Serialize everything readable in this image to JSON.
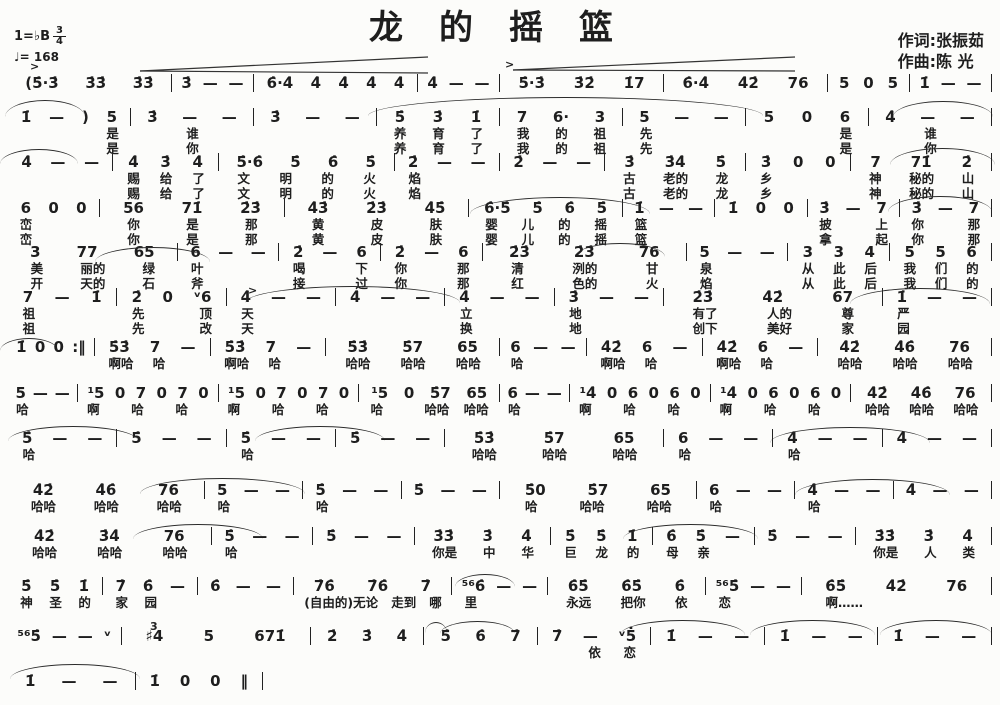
{
  "colors": {
    "ink": "#1e1e1e",
    "paper": "#fcfcfa"
  },
  "header": {
    "title": "龙的摇篮",
    "key": "1=♭B",
    "time_numerator": "3",
    "time_denominator": "4",
    "tempo": "♩= 168",
    "lyricist": "作词:张振茹",
    "composer": "作曲:陈  光"
  },
  "systems": [
    {
      "top": 74,
      "notes": [
        "(5̇·3̇ 3̇3̇ 3̇3̇",
        "3̇ — —",
        "6̇·4̇ 4̇ 4̇ 4̇ 4̇",
        "4̇ — —",
        "5̇·3̇ 3̇2̇ 1̇7",
        "6̇·4̇ 4̇2̇ 76",
        "5 0 5",
        "1̇ — —"
      ],
      "lyrics": []
    },
    {
      "top": 108,
      "notes": [
        "1̇ — ) 5",
        "3̇ — —",
        "3̇ — —",
        "5̇ 3̇ 1̇",
        "7 6· 3",
        "5 — —",
        "5 0 6",
        "4̇ — —"
      ],
      "lyrics": [
        [
          "　 　 　 是",
          "谁",
          "",
          "养 育 了",
          "我 的 祖",
          "先 　 　",
          "　 　 是",
          "谁"
        ],
        [
          "　 　 　 是",
          "你",
          "",
          "养 育 了",
          "我 的 祖",
          "先 　 　",
          "　 　 是",
          "你"
        ]
      ]
    },
    {
      "top": 153,
      "notes": [
        "4̇ — —",
        "4̇ 3̇ 4̇",
        "5̇·6̇ 5̇ 6̇ 5̇",
        "2̇ — —",
        "2̇ — —",
        "3̇ 3̇4̇ 5̇",
        "3̇ 0 0",
        "7 71̇ 2̇"
      ],
      "lyrics": [
        [
          "",
          "赐 给 了",
          "文 明 的 火",
          "焰 　 　",
          "",
          "古 老的 龙",
          "乡 　 　",
          "神 秘的 山"
        ],
        [
          "",
          "赐 给 了",
          "文 明 的 火",
          "焰 　 　",
          "",
          "古 老的 龙",
          "乡 　 　",
          "神 秘的 山"
        ]
      ]
    },
    {
      "top": 199,
      "notes": [
        "6 0 0",
        "56 71̇ 2̇3̇",
        "4̇3̇ 2̇3̇ 4̇5̇",
        "6̇·5̇ 5̇ 6̇ 5̇",
        "1̇ — —",
        "1̇ 0 0",
        "3̇ — 7",
        "3̇ — 7"
      ],
      "lyrics": [
        [
          "峦 　 　",
          "你 是 那",
          "黄 皮 肤",
          "婴 儿 的 摇",
          "篮 　 　",
          "",
          "披 　 上",
          "你 　 那"
        ],
        [
          "峦 　 　",
          "你 是 那",
          "黄 皮 肤",
          "婴 儿 的 摇",
          "篮 　 　",
          "",
          "拿 　 起",
          "你 　 那"
        ]
      ]
    },
    {
      "top": 243,
      "notes": [
        "3 77 65",
        "6 — —",
        "2̇ — 6",
        "2̇ — 6",
        "2̇3̇ 2̇3̇ 76",
        "5 — —",
        "3 3 4",
        "5 5 6"
      ],
      "lyrics": [
        [
          "美 丽的 绿",
          "叶 　 　",
          "喝 　 下",
          "你 　 那",
          "清 洌的 甘",
          "泉 　 　",
          "从 此 后",
          "我 们 的"
        ],
        [
          "开 天的 石",
          "斧 　 　",
          "接 　 过",
          "你 　 那",
          "红 色的 火",
          "焰 　 　",
          "从 此 后",
          "我 们 的"
        ]
      ]
    },
    {
      "top": 288,
      "notes": [
        "7 — 1̇",
        "2̇ 0 ᵛ6",
        "4̇ — —",
        "4̇ — —",
        "4̇ — —",
        "3̇ — —",
        "2̇3̇ 4̇2̇ 67",
        "1̇ — —"
      ],
      "lyrics": [
        [
          "祖 　 　",
          "先 　 顶",
          "天 　 　",
          "",
          "立 　 　",
          "地 　 　",
          "有了 人的 尊",
          "严 　 　"
        ],
        [
          "祖 　 　",
          "先 　 改",
          "天 　 　",
          "",
          "换 　 　",
          "地 　 　",
          "创下 美好 家",
          "园 　 　"
        ]
      ]
    },
    {
      "top": 338,
      "notes": [
        "1̇ 0 0 :‖",
        "5̇3̇ 7 —",
        "5̇3̇ 7 —",
        "5̇3̇ 5̇7 65",
        "6 — —",
        "4̇2̇ 6 —",
        "4̇2̇ 6 —",
        "4̇2̇ 4̇6̇ 76"
      ],
      "lyrics": [
        [
          "",
          "啊哈 哈 　",
          "啊哈 哈 　",
          "哈哈 哈哈 哈哈",
          "哈 　 　",
          "啊哈 哈 　",
          "啊哈 哈 　",
          "哈哈 哈哈 哈哈"
        ]
      ]
    },
    {
      "top": 384,
      "notes": [
        "5 — —",
        "¹5 0 7 0 7 0",
        "¹5 0 7 0 7 0",
        "¹5 0 5̇7 65",
        "6 — —",
        "¹4̇ 0 6 0 6 0",
        "¹4̇ 0 6 0 6 0",
        "4̇2̇ 4̇6̇ 76"
      ],
      "lyrics": [
        [
          "哈 　 　",
          "啊 　 哈 　 哈 　",
          "啊 　 哈 　 哈 　",
          "哈 　 哈哈 哈哈",
          "哈 　 　",
          "啊 　 哈 　 哈 　",
          "啊 　 哈 　 哈 　",
          "哈哈 哈哈 哈哈"
        ]
      ]
    },
    {
      "top": 429,
      "notes": [
        "5̇ — —",
        "5̇ — —",
        "5̇ — —",
        "5̇ — —",
        "5̇3̇ 5̇7 65",
        "6 — —",
        "4̇ — —",
        "4̇ — —"
      ],
      "lyrics": [
        [
          "哈 　 　",
          "",
          "哈 　 　",
          "",
          "哈哈 哈哈 哈哈",
          "哈 　 　",
          "哈 　 　",
          ""
        ]
      ]
    },
    {
      "top": 481,
      "notes": [
        "4̇2̇ 4̇6̇ 76",
        "5 — —",
        "5̇ — —",
        "5̇ — —",
        "5̇0 5̇7 65",
        "6 — —",
        "4̇ — —",
        "4̇ — —"
      ],
      "lyrics": [
        [
          "哈哈 哈哈 哈哈",
          "哈 　 　",
          "哈 　 　",
          "",
          "哈 哈哈 哈哈",
          "哈 　 　",
          "哈 　 　",
          ""
        ]
      ]
    },
    {
      "top": 527,
      "notes": [
        "4̇2̇ 3̇4̇ 76",
        "5̇ — —",
        "5̇ — —",
        "3̇3̇ 3̇ 4̇",
        "5̇ 5̇ 1̇",
        "6̇ 5̇ —",
        "5̇ — —",
        "3̇3̇ 3̇ 4̇"
      ],
      "lyrics": [
        [
          "哈哈 哈哈 哈哈",
          "哈 　 　",
          "",
          "你是 中 华",
          "巨 龙 的",
          "母 亲 　",
          "",
          "你是 人 类"
        ]
      ]
    },
    {
      "top": 577,
      "notes": [
        "5̇ 5̇ 1̇",
        "7̇ 6̇ —",
        "6̇ — —",
        "7̇6̇ 7̇6̇ 7̇",
        "⁵⁶6̇ — —",
        "6̇5̇ 6̇5̇ 6̇",
        "⁵⁶5̇ — —",
        "6̇5̇ 4̇2̇ 76"
      ],
      "lyrics": [
        [
          "神 圣 的",
          "家 园 　",
          "",
          "(自由的)无论 走到 哪",
          "里 　 　",
          "永远 把你 依",
          "恋 　 　",
          "啊…… 　 　"
        ]
      ]
    },
    {
      "top": 627,
      "notes": [
        "⁵⁶5̇ — — ᵛ",
        "♯4 5 671̇",
        "2̇ 3̇ 4̇",
        "5̇ 6̇ 7̇",
        "7̇ — ᵛ5̇",
        "1̇ — —",
        "1̇ — —",
        "1̇ — —"
      ],
      "lyrics": [
        [
          "",
          "",
          "",
          "",
          "　 依 恋",
          "",
          "",
          ""
        ]
      ]
    },
    {
      "top": 672,
      "width": 255,
      "notes": [
        "1̇ — —",
        "1̇ 0 0 ‖"
      ],
      "lyrics": []
    }
  ]
}
